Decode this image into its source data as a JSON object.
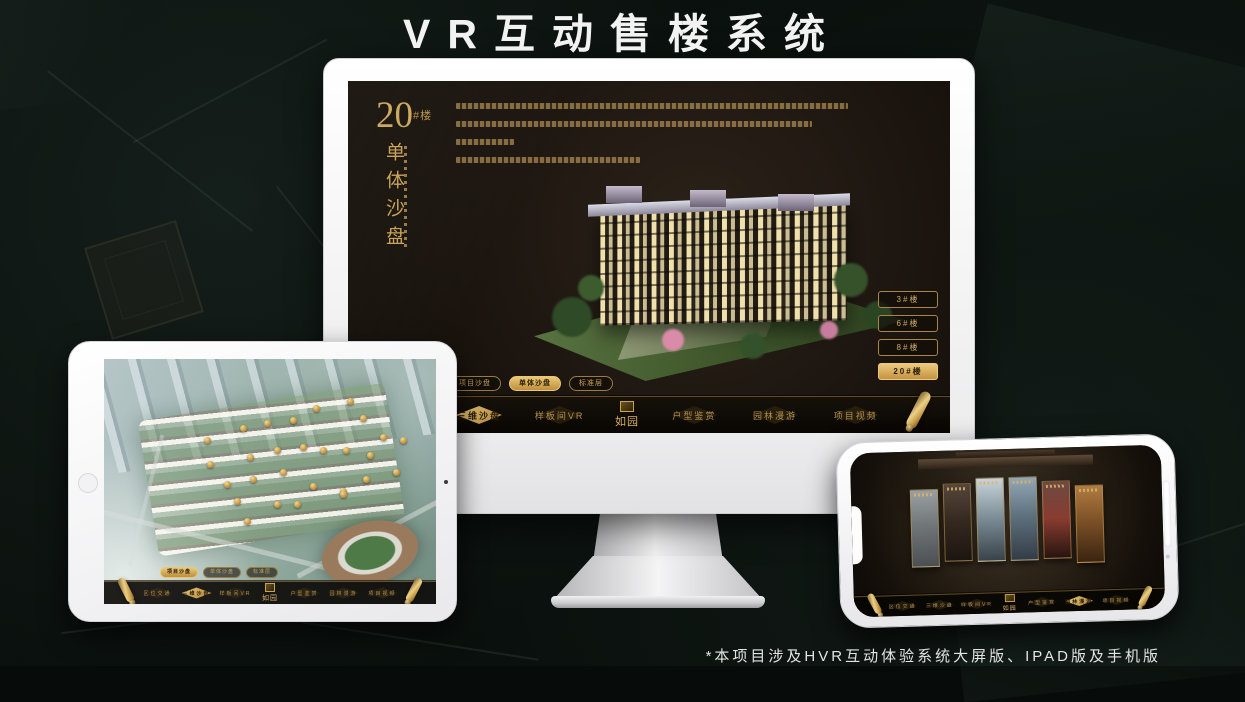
{
  "page": {
    "title": "VR互动售楼系统",
    "footnote": "*本项目涉及HVR互动体验系统大屏版、IPAD版及手机版"
  },
  "colors": {
    "gold": "#d2a855",
    "gold_deep": "#8a6a2f",
    "screen_bg": "#1d1610",
    "active_text": "#2b1e08"
  },
  "app": {
    "logo": "如园",
    "nav_items": [
      "区位交通",
      "三维沙盘",
      "样板间VR",
      "户型鉴赏",
      "园林漫游",
      "项目视频"
    ],
    "sub_tabs": [
      "项目沙盘",
      "单体沙盘",
      "标准层"
    ]
  },
  "desktop": {
    "active_nav_index": 1,
    "active_tab_index": 1,
    "headline": {
      "number": "20",
      "unit": "#楼",
      "vertical_title": "单体沙盘"
    },
    "building_buttons": [
      {
        "label": "3#楼",
        "active": false
      },
      {
        "label": "6#楼",
        "active": false
      },
      {
        "label": "8#楼",
        "active": false
      },
      {
        "label": "20#楼",
        "active": true
      }
    ]
  },
  "tablet": {
    "active_nav_index": 1,
    "active_tab_index": 0,
    "markers": [
      {
        "x": 31,
        "y": 33
      },
      {
        "x": 42,
        "y": 28
      },
      {
        "x": 49,
        "y": 26
      },
      {
        "x": 57,
        "y": 25
      },
      {
        "x": 64,
        "y": 20
      },
      {
        "x": 74,
        "y": 17
      },
      {
        "x": 78,
        "y": 24
      },
      {
        "x": 84,
        "y": 32
      },
      {
        "x": 90,
        "y": 33
      },
      {
        "x": 32,
        "y": 43
      },
      {
        "x": 44,
        "y": 40
      },
      {
        "x": 52,
        "y": 37
      },
      {
        "x": 60,
        "y": 36
      },
      {
        "x": 66,
        "y": 37
      },
      {
        "x": 73,
        "y": 37
      },
      {
        "x": 80,
        "y": 39
      },
      {
        "x": 88,
        "y": 46
      },
      {
        "x": 37,
        "y": 51
      },
      {
        "x": 45,
        "y": 49
      },
      {
        "x": 54,
        "y": 46
      },
      {
        "x": 63,
        "y": 52
      },
      {
        "x": 72,
        "y": 54
      },
      {
        "x": 79,
        "y": 49
      },
      {
        "x": 40,
        "y": 58
      },
      {
        "x": 52,
        "y": 59
      },
      {
        "x": 58,
        "y": 59
      },
      {
        "x": 72,
        "y": 55
      },
      {
        "x": 43,
        "y": 66
      }
    ]
  },
  "phone": {
    "active_nav_index": 4,
    "panels": [
      {
        "from": "#9aa0a2",
        "mid": "#6f7476",
        "to": "#4b4f52"
      },
      {
        "from": "#55463a",
        "mid": "#35291f",
        "to": "#1c1510"
      },
      {
        "from": "#c9d4da",
        "mid": "#7b8d96",
        "to": "#39424a"
      },
      {
        "from": "#93a7b4",
        "mid": "#5d6f7c",
        "to": "#323c46"
      },
      {
        "from": "#6b4a41",
        "mid": "#8a3c30",
        "to": "#26150f"
      },
      {
        "from": "#b07c42",
        "mid": "#7a4f26",
        "to": "#3a2410"
      }
    ]
  }
}
